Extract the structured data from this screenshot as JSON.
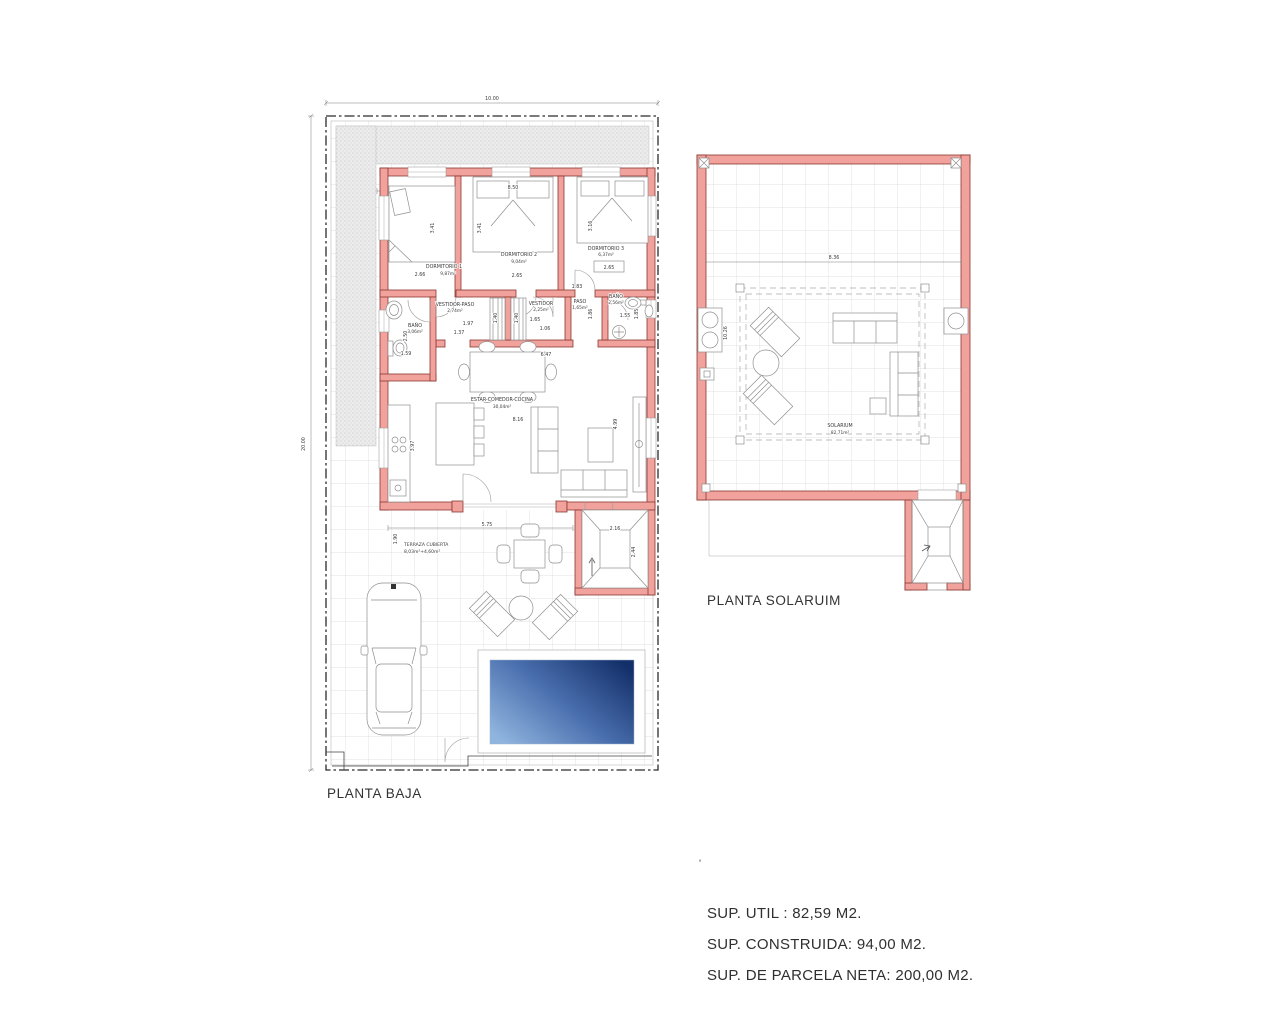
{
  "colors": {
    "wall_fill": "#f1a29c",
    "wall_stroke": "#8a3730",
    "pool_light": "#8fb4de",
    "pool_dark": "#14306a",
    "grid_line": "#d7d7d7"
  },
  "baja": {
    "title": "PLANTA BAJA",
    "dims": {
      "overall_w": "10.00",
      "overall_h": "20.00",
      "top_inner": "8.50",
      "living_w": "8.16",
      "living_w2": "6.47",
      "living_h": "4.99",
      "kitchen_h": "3.97",
      "terrace_w": "5.75",
      "terrace_h": "1.90",
      "stairs_w": "2.16",
      "stairs_h": "2.44"
    },
    "rooms": {
      "dorm1": {
        "label": "DORMITORIO 1",
        "area": "9,87m²",
        "w": "2.66",
        "h": "3.41"
      },
      "dorm2": {
        "label": "DORMITORIO 2",
        "area": "9,04m²",
        "w": "2.65",
        "h": "3.41"
      },
      "dorm3": {
        "label": "DORMITORIO 3",
        "area": "6,37m²",
        "w": "2.65",
        "h": "3.16"
      },
      "vestidor_paso": {
        "label": "VESTIDOR-PASO",
        "area": "2,74m²",
        "d1": "1.97",
        "d2": "1.37",
        "d3": "1.40"
      },
      "vestidor": {
        "label": "VESTIDOR",
        "area": "2,25m²",
        "d1": "1.65",
        "d2": "1.06",
        "d3": "1.40"
      },
      "paso": {
        "label": "PASO",
        "area": "1,65m²",
        "d0": "1.83",
        "d1": "1.86"
      },
      "bano_dcha": {
        "label": "BAÑO",
        "area": "2,56m²",
        "d1": "1.55",
        "d2": "1.85"
      },
      "bano_izq": {
        "label": "BAÑO",
        "area": "3,06m²",
        "d1": "2.50",
        "d2": "1.59"
      },
      "estar": {
        "label": "ESTAR-COMEDOR-COCINA",
        "area": "30,04m²"
      },
      "terraza": {
        "label": "TERRAZA CUBIERTA",
        "area": "8,03m²+4,60m²"
      }
    }
  },
  "solarium": {
    "title": "PLANTA SOLARUIM",
    "label": "SOLARIUM",
    "area": "82,71m²",
    "dims": {
      "w": "8.36",
      "h": "10.26"
    }
  },
  "summary": {
    "mark": "'",
    "line1": "SUP. UTIL : 82,59 M2.",
    "line2": "SUP. CONSTRUIDA: 94,00 M2.",
    "line3": "SUP. DE PARCELA NETA: 200,00 M2."
  }
}
